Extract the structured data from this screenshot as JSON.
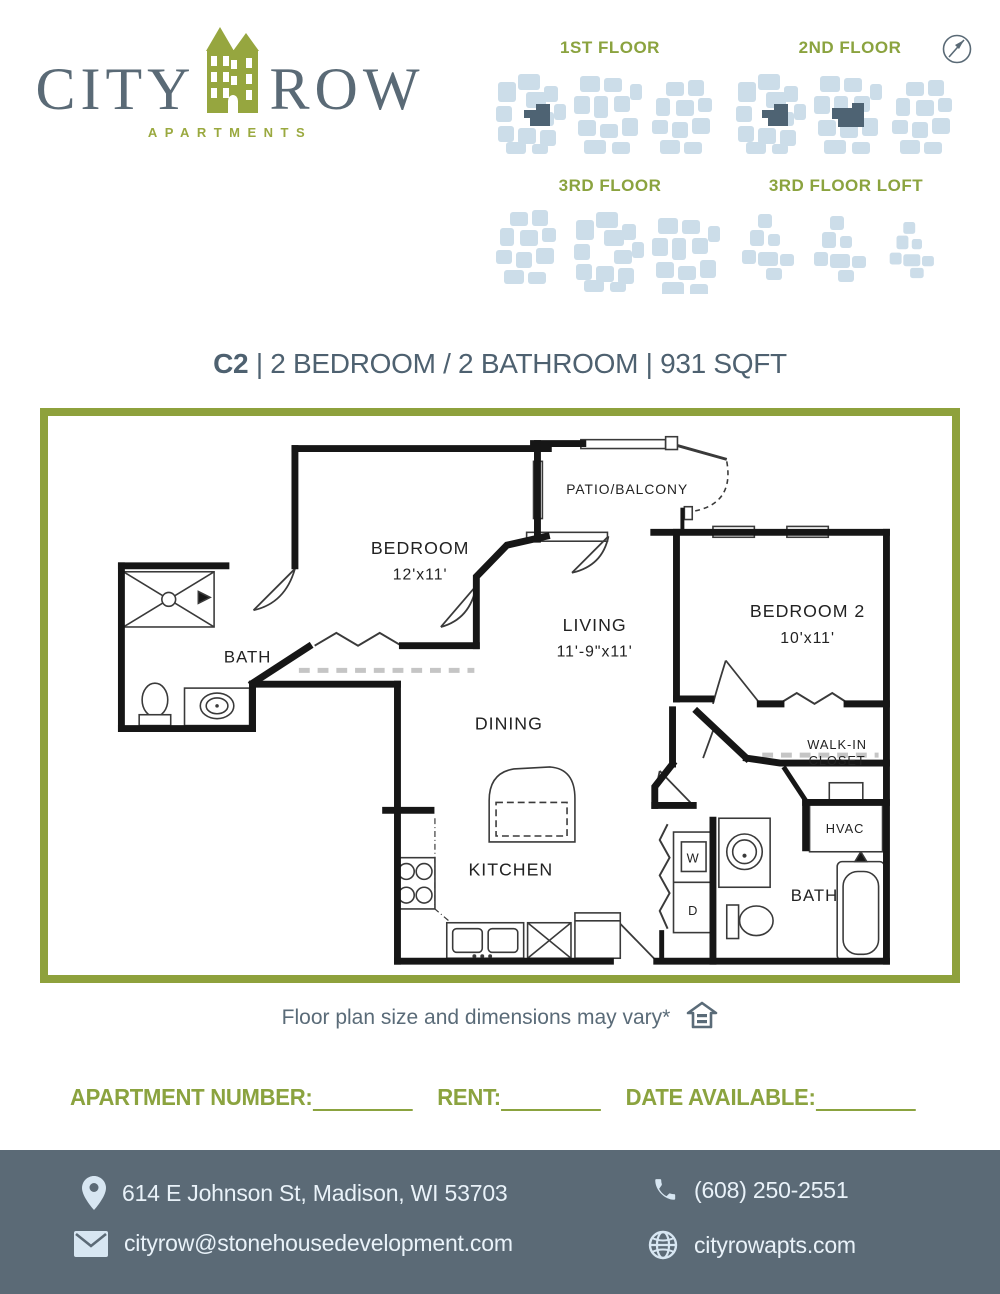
{
  "brand": {
    "name_left": "CITY",
    "name_right": "ROW",
    "subtitle": "APARTMENTS"
  },
  "floor_maps": {
    "items": [
      {
        "label": "1ST FLOOR"
      },
      {
        "label": "2ND FLOOR"
      },
      {
        "label": "3RD FLOOR"
      },
      {
        "label": "3RD FLOOR LOFT"
      }
    ]
  },
  "title": {
    "unit": "C2",
    "separator": "|",
    "specs": "2 BEDROOM / 2 BATHROOM",
    "sqft": "931 SQFT"
  },
  "floor_plan": {
    "rooms": [
      {
        "label": "BEDROOM",
        "x": 375,
        "y": 140,
        "size": 18
      },
      {
        "label": "12'x11'",
        "x": 375,
        "y": 166,
        "size": 16
      },
      {
        "label": "PATIO/BALCONY",
        "x": 585,
        "y": 79,
        "size": 14
      },
      {
        "label": "LIVING",
        "x": 552,
        "y": 218,
        "size": 18
      },
      {
        "label": "11'-9\"x11'",
        "x": 552,
        "y": 244,
        "size": 16
      },
      {
        "label": "BEDROOM 2",
        "x": 768,
        "y": 204,
        "size": 18
      },
      {
        "label": "10'x11'",
        "x": 768,
        "y": 230,
        "size": 16
      },
      {
        "label": "BATH",
        "x": 200,
        "y": 250,
        "size": 17
      },
      {
        "label": "DINING",
        "x": 465,
        "y": 318,
        "size": 18
      },
      {
        "label": "KITCHEN",
        "x": 467,
        "y": 466,
        "size": 18
      },
      {
        "label": "WALK-IN",
        "x": 798,
        "y": 338,
        "size": 13
      },
      {
        "label": "CLOSET",
        "x": 798,
        "y": 354,
        "size": 13
      },
      {
        "label": "HVAC",
        "x": 806,
        "y": 423,
        "size": 13
      },
      {
        "label": "BATH",
        "x": 775,
        "y": 492,
        "size": 17
      },
      {
        "label": "W",
        "x": 652,
        "y": 453,
        "size": 13
      },
      {
        "label": "D",
        "x": 652,
        "y": 506,
        "size": 13
      }
    ]
  },
  "caption": {
    "text": "Floor plan size and dimensions may vary*"
  },
  "form": {
    "fields": [
      {
        "label": "APARTMENT NUMBER:"
      },
      {
        "label": "RENT:"
      },
      {
        "label": "DATE AVAILABLE:"
      }
    ]
  },
  "footer": {
    "address": "614 E Johnson St, Madison, WI 53703",
    "phone": "(608) 250-2551",
    "email": "cityrow@stonehousedevelopment.com",
    "website": "cityrowapts.com"
  },
  "colors": {
    "olive": "#8ea13c",
    "slate": "#55656f",
    "footer_background": "#5b6a76",
    "map_unit_light": "#ccdde9",
    "map_unit_highlight": "#4e6373",
    "wall": "#161616"
  }
}
